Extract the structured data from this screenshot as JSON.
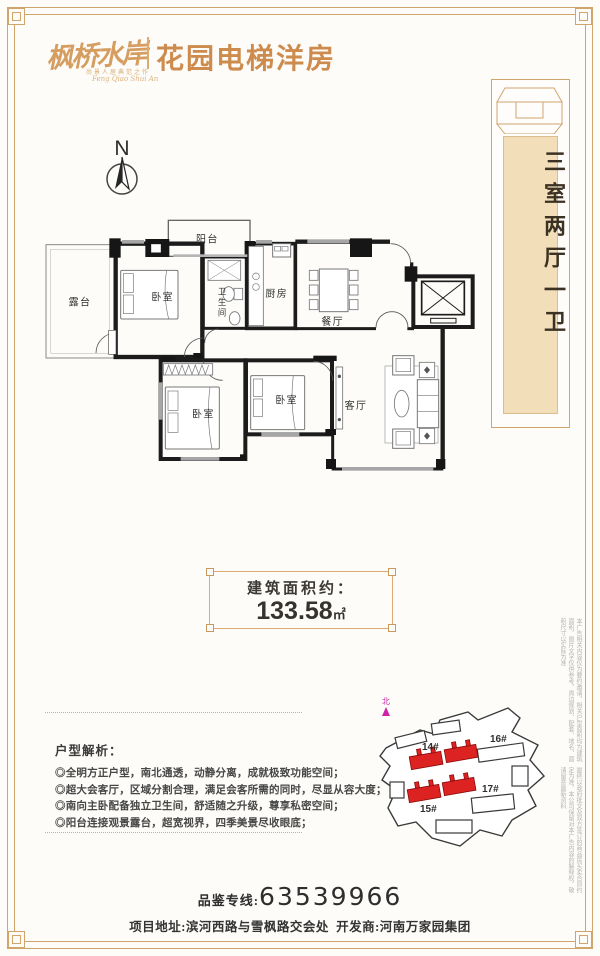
{
  "page": {
    "accent_gold": "#cfa56c",
    "title_orange": "#cd8b4d",
    "scroll_tan": "#f2dfba",
    "highlight_red": "#dd2222",
    "north_magenta": "#cc22aa"
  },
  "header": {
    "logo_main": "枫桥水岸",
    "logo_tagline": "尚景人居典范之作",
    "logo_tagline_en": "Feng Qiao Shui An",
    "title": "花园电梯洋房"
  },
  "scroll": {
    "text": "三室两厅一卫"
  },
  "compass": {
    "label": "N"
  },
  "floorplan": {
    "labels": {
      "terrace": "露台",
      "bedroom_main": "卧室",
      "balcony": "阳台",
      "bath_1": "卫",
      "bath_2": "生",
      "bath_3": "间",
      "kitchen": "厨房",
      "dining": "餐厅",
      "living": "客厅",
      "bedroom_2": "卧室",
      "bedroom_3": "卧室"
    }
  },
  "area_box": {
    "label": "建筑面积约：",
    "value": "133.58",
    "unit": "㎡"
  },
  "analysis": {
    "title": "户型解析：",
    "items": [
      "◎全明方正户型，南北通透，动静分离，成就极致功能空间；",
      "◎超大会客厅，区域分割合理，满足会客所需的同时，尽显从容大度；",
      "◎南向主卧配备独立卫生间，舒适随之升级，尊享私密空间；",
      "◎阳台连接观景露台，超宽视界，四季美景尽收眼底；"
    ]
  },
  "siteplan": {
    "north": "北",
    "labels": {
      "b14": "14#",
      "b15": "15#",
      "b16": "16#",
      "b17": "17#"
    }
  },
  "footer": {
    "hotline_label": "品鉴专线:",
    "hotline_number": "63539966",
    "address_label": "项目地址:",
    "address_value": "滨河西路与雪枫路交会处",
    "developer_label": "开发商:",
    "developer_value": "河南万家园集团"
  },
  "disclaimer": {
    "col1": "本广告相关内容仅为要约邀请，相关户型面积均为建筑面积，图片文字仅供参考，周边规划、配套、地名、面积尺寸以实际为准",
    "col2": "最终以政府批文及双方签订的商品房买卖合同约定为准，本公司保留对本广告内容的解释权，敬请留意最新资料"
  }
}
